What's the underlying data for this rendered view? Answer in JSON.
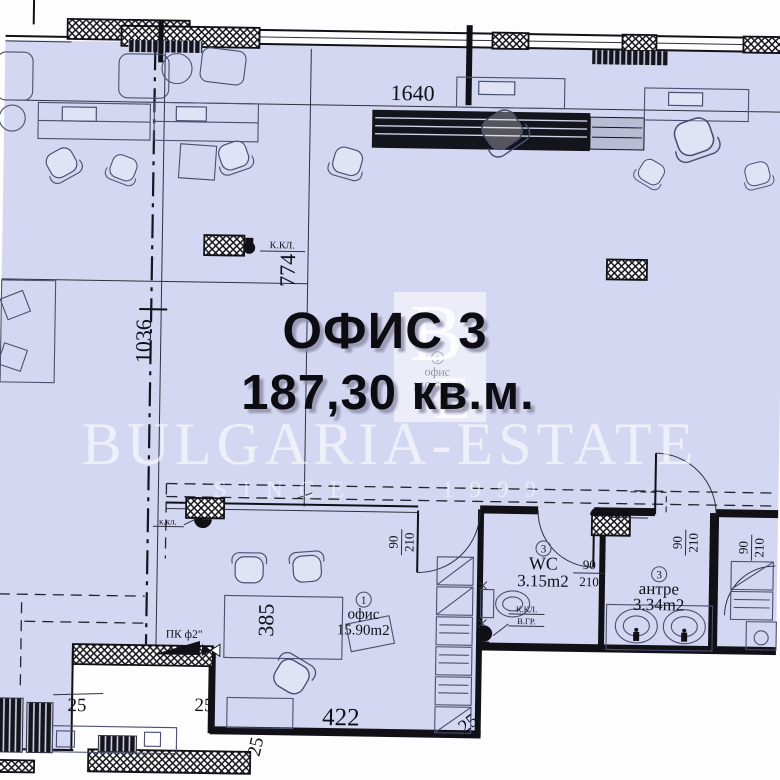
{
  "plan": {
    "title_line1": "ОФИС 3",
    "title_line2": "187,30 кв.м.",
    "unit": {
      "number": "1",
      "name": "офис",
      "area": "146,66m2"
    },
    "rooms": {
      "office": {
        "number": "1",
        "name": "офис",
        "area": "15.90m2"
      },
      "wc": {
        "number": "3",
        "name": "WC",
        "area": "3.15m2"
      },
      "antre": {
        "number": "3",
        "name": "антре",
        "area": "3.34m2"
      }
    },
    "dims": {
      "d1640": "1640",
      "d1036": "1036",
      "d774": "774",
      "d385": "385",
      "d422": "422",
      "d25": "25"
    },
    "door": {
      "w": "90",
      "h": "210"
    },
    "notes": {
      "kkl": "К.КЛ.",
      "kkl_lc": "к.кл.",
      "vgr": "В.ГР.",
      "pk": "ПК ф2\""
    },
    "colors": {
      "floor": "#d4d7f1",
      "wall": "#101016",
      "accent": "#4a5070"
    }
  },
  "watermark": {
    "brand": "BULGARIA-ESTATE",
    "since": "SINCE",
    "year": "1999",
    "logo_b": "B",
    "logo_e": "E"
  }
}
